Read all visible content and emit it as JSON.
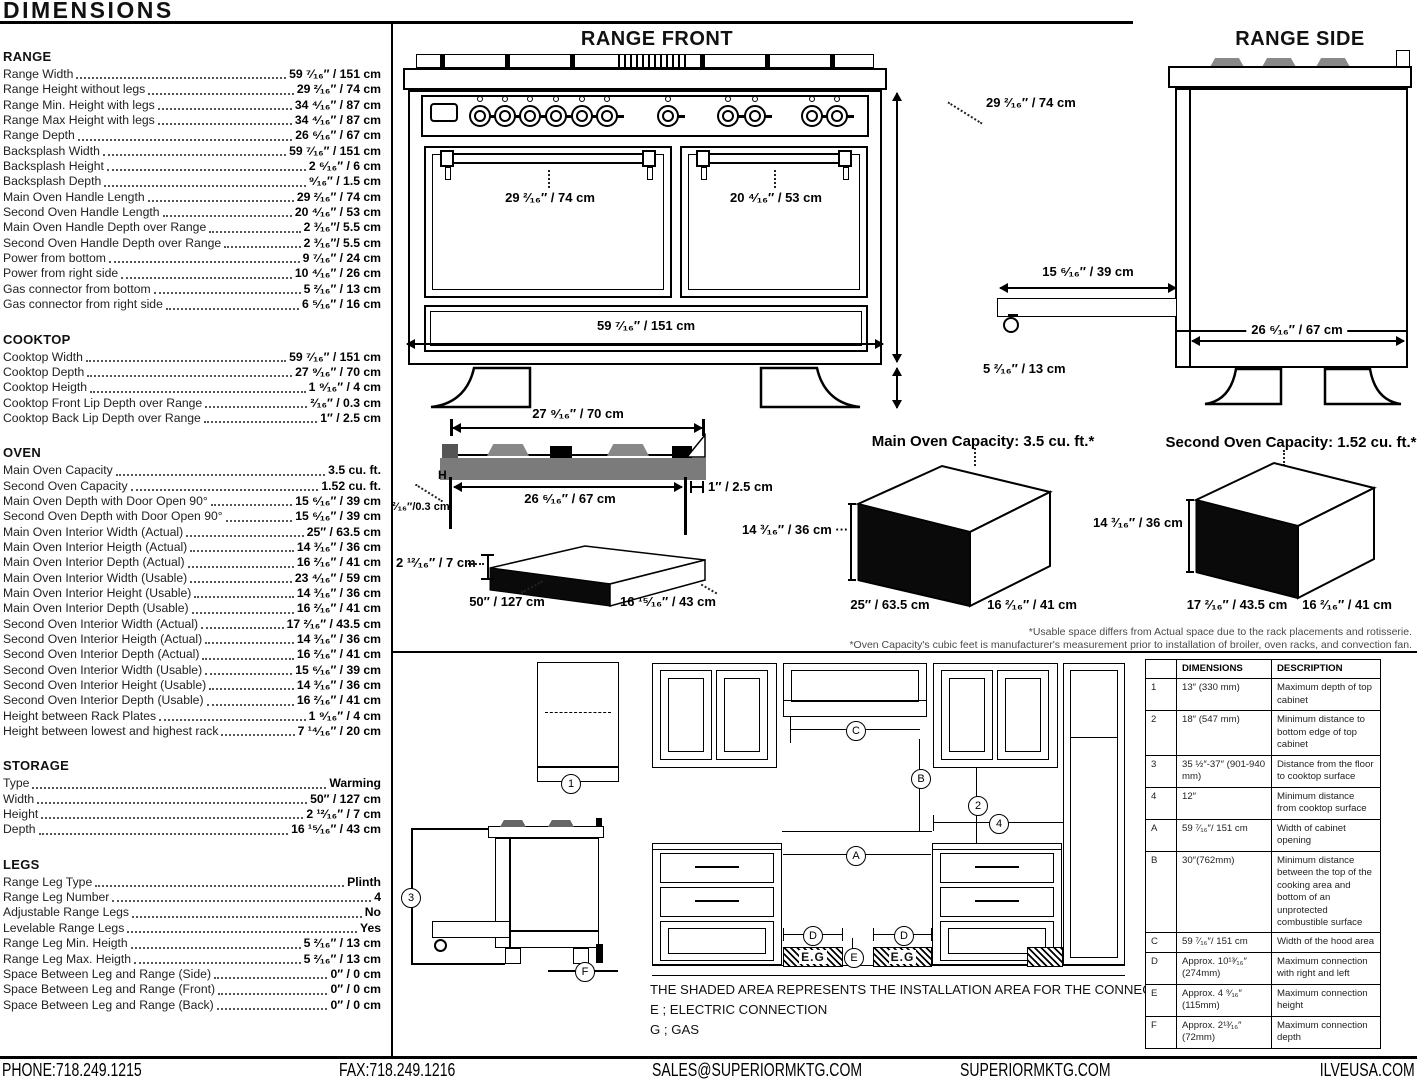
{
  "page": {
    "title": "DIMENSIONS"
  },
  "specs": {
    "sections": [
      {
        "heading": "RANGE",
        "rows": [
          {
            "label": "Range Width",
            "value": "59 ⁷⁄₁₆″ / 151 cm"
          },
          {
            "label": "Range Height without legs",
            "value": "29 ²⁄₁₆″ / 74 cm"
          },
          {
            "label": "Range Min. Height with legs",
            "value": "34 ⁴⁄₁₆″ / 87 cm"
          },
          {
            "label": "Range Max Height with legs",
            "value": "34 ⁴⁄₁₆″ / 87 cm"
          },
          {
            "label": "Range Depth",
            "value": "26 ⁶⁄₁₆″ / 67 cm"
          },
          {
            "label": "Backsplash Width",
            "value": "59 ⁷⁄₁₆″ / 151 cm"
          },
          {
            "label": "Backsplash Height",
            "value": "2 ⁶⁄₁₆″ / 6 cm"
          },
          {
            "label": "Backsplash Depth",
            "value": "⁹⁄₁₆″ / 1.5 cm"
          },
          {
            "label": "Main Oven Handle Length",
            "value": "29 ²⁄₁₆″ / 74 cm"
          },
          {
            "label": "Second Oven Handle Length",
            "value": "20 ⁴⁄₁₆″ / 53 cm"
          },
          {
            "label": "Main Oven Handle Depth over Range",
            "value": "2 ³⁄₁₆″/ 5.5 cm"
          },
          {
            "label": "Second Oven Handle Depth over Range",
            "value": "2 ³⁄₁₆″/ 5.5 cm"
          },
          {
            "label": "Power from bottom",
            "value": "9 ⁷⁄₁₆″ / 24 cm"
          },
          {
            "label": "Power from right side",
            "value": "10 ⁴⁄₁₆″ / 26 cm"
          },
          {
            "label": "Gas connector from bottom",
            "value": "5 ²⁄₁₆″ / 13 cm"
          },
          {
            "label": "Gas connector from right side",
            "value": "6 ⁵⁄₁₆″ / 16 cm"
          }
        ]
      },
      {
        "heading": "COOKTOP",
        "rows": [
          {
            "label": "Cooktop Width",
            "value": "59 ⁷⁄₁₆″ / 151 cm"
          },
          {
            "label": "Cooktop Depth",
            "value": "27 ⁹⁄₁₆″ / 70 cm"
          },
          {
            "label": "Cooktop Heigth",
            "value": "1 ⁹⁄₁₆″ / 4 cm"
          },
          {
            "label": "Cooktop Front Lip Depth over Range",
            "value": "²⁄₁₆″ / 0.3 cm"
          },
          {
            "label": "Cooktop Back Lip Depth over Range",
            "value": "1″ / 2.5 cm"
          }
        ]
      },
      {
        "heading": "OVEN",
        "rows": [
          {
            "label": "Main Oven Capacity",
            "value": "3.5 cu. ft."
          },
          {
            "label": "Second Oven Capacity",
            "value": "1.52 cu. ft."
          },
          {
            "label": "Main Oven Depth with Door Open 90°",
            "value": "15 ⁶⁄₁₆″ / 39 cm"
          },
          {
            "label": "Second Oven Depth with Door Open 90°",
            "value": "15 ⁶⁄₁₆″ / 39 cm"
          },
          {
            "label": "Main Oven Interior Width (Actual)",
            "value": "25″ / 63.5 cm"
          },
          {
            "label": "Main Oven Interior Heigth (Actual)",
            "value": "14 ³⁄₁₆″ / 36 cm"
          },
          {
            "label": "Main Oven Interior Depth (Actual)",
            "value": "16 ²⁄₁₆″ / 41 cm"
          },
          {
            "label": "Main Oven Interior Width (Usable)",
            "value": "23 ⁴⁄₁₆″ / 59 cm"
          },
          {
            "label": "Main Oven Interior Height (Usable)",
            "value": "14 ³⁄₁₆″ / 36 cm"
          },
          {
            "label": "Main Oven Interior Depth (Usable)",
            "value": "16 ²⁄₁₆″ / 41 cm"
          },
          {
            "label": "Second Oven Interior Width (Actual)",
            "value": "17 ²⁄₁₆″ / 43.5 cm"
          },
          {
            "label": "Second Oven Interior Heigth (Actual)",
            "value": "14 ³⁄₁₆″ / 36 cm"
          },
          {
            "label": "Second Oven Interior Depth (Actual)",
            "value": "16 ²⁄₁₆″ / 41 cm"
          },
          {
            "label": "Second Oven Interior Width (Usable)",
            "value": "15 ⁶⁄₁₆″ / 39 cm"
          },
          {
            "label": "Second Oven Interior Height (Usable)",
            "value": "14 ³⁄₁₆″ / 36 cm"
          },
          {
            "label": "Second Oven Interior Depth (Usable)",
            "value": "16 ²⁄₁₆″ / 41 cm"
          },
          {
            "label": "Height between Rack Plates",
            "value": "1 ⁹⁄₁₆″ / 4 cm"
          },
          {
            "label": "Height between lowest and highest rack",
            "value": "7 ¹⁴⁄₁₆″ / 20 cm"
          }
        ]
      },
      {
        "heading": "STORAGE",
        "rows": [
          {
            "label": "Type",
            "value": "Warming"
          },
          {
            "label": "Width",
            "value": "50″ / 127 cm"
          },
          {
            "label": "Height",
            "value": "2 ¹²⁄₁₆″ / 7 cm"
          },
          {
            "label": "Depth",
            "value": "16 ¹⁵⁄₁₆″ / 43 cm"
          }
        ]
      },
      {
        "heading": "LEGS",
        "rows": [
          {
            "label": "Range Leg Type",
            "value": "Plinth"
          },
          {
            "label": "Range Leg Number",
            "value": "4"
          },
          {
            "label": "Adjustable Range Legs",
            "value": "No"
          },
          {
            "label": "Levelable Range Legs",
            "value": "Yes"
          },
          {
            "label": "Range Leg Min. Heigth",
            "value": "5 ²⁄₁₆″ / 13 cm"
          },
          {
            "label": "Range Leg Max. Heigth",
            "value": "5 ²⁄₁₆″ / 13 cm"
          },
          {
            "label": "Space Between Leg and Range (Side)",
            "value": "0″ / 0 cm"
          },
          {
            "label": "Space Between Leg and Range (Front)",
            "value": "0″ / 0 cm"
          },
          {
            "label": "Space Between Leg and Range (Back)",
            "value": "0″ / 0 cm"
          }
        ]
      }
    ]
  },
  "diagrams": {
    "range_front": {
      "title": "RANGE FRONT",
      "handle_main": "29 ²⁄₁₆″ / 74 cm",
      "handle_second": "20 ⁴⁄₁₆″ / 53 cm",
      "width": "59 ⁷⁄₁₆″ / 151 cm",
      "height": "29 ²⁄₁₆″ / 74 cm",
      "legs": "5 ²⁄₁₆″ / 13 cm"
    },
    "range_side": {
      "title": "RANGE SIDE",
      "door_open": "15 ⁶⁄₁₆″ / 39 cm",
      "depth": "26 ⁶⁄₁₆″ / 67 cm"
    },
    "cooktop_profile": {
      "width_top": "27 ⁹⁄₁₆″ / 70 cm",
      "width_bottom": "26 ⁶⁄₁₆″ / 67 cm",
      "back_lip": "1″ / 2.5 cm",
      "front_lip": "²⁄₁₆″/0.3 cm",
      "h_mark": "H"
    },
    "storage_drawer": {
      "height": "2 ¹²⁄₁₆″ / 7 cm",
      "width": "50″ / 127 cm",
      "depth": "16 ¹⁵⁄₁₆″ / 43 cm"
    },
    "main_oven": {
      "title": "Main Oven Capacity: 3.5 cu. ft.*",
      "height": "14 ³⁄₁₆″ / 36 cm ···",
      "width": "25″ / 63.5 cm",
      "depth": "16 ²⁄₁₆″ / 41 cm"
    },
    "second_oven": {
      "title": "Second Oven Capacity: 1.52 cu. ft.*",
      "height": "14 ³⁄₁₆″ / 36 cm",
      "width": "17 ²⁄₁₆″ / 43.5 cm",
      "depth": "16 ²⁄₁₆″ / 41 cm"
    },
    "footnotes": [
      "*Usable space differs from Actual space due to the rack placements and rotisserie.",
      "*Oven Capacity's cubic feet is manufacturer's measurement prior to installation of broiler, oven racks, and convection fan."
    ]
  },
  "installation": {
    "side_callouts": [
      "1",
      "3",
      "F"
    ],
    "front_callouts": [
      "C",
      "B",
      "2",
      "4",
      "A",
      "D",
      "D",
      "E"
    ],
    "shaded_label": "E.G",
    "notes": [
      "THE SHADED AREA REPRESENTS THE INSTALLATION AREA FOR THE CONNECTIONS;",
      "E ; ELECTRIC CONNECTION",
      "G ; GAS"
    ],
    "table": {
      "headers": [
        "",
        "DIMENSIONS",
        "DESCRIPTION"
      ],
      "rows": [
        {
          "key": "1",
          "dim": "13″ (330 mm)",
          "desc": "Maximum depth of top cabinet"
        },
        {
          "key": "2",
          "dim": "18″ (547 mm)",
          "desc": "Minimum distance to bottom edge of top cabinet"
        },
        {
          "key": "3",
          "dim": "35 ½″-37″ (901-940 mm)",
          "desc": "Distance from the floor to cooktop surface"
        },
        {
          "key": "4",
          "dim": "12″",
          "desc": "Minimum distance from cooktop surface"
        },
        {
          "key": "A",
          "dim": "59 ⁷⁄₁₆″/ 151 cm",
          "desc": "Width of cabinet opening"
        },
        {
          "key": "B",
          "dim": "30″(762mm)",
          "desc": "Minimum distance between the top of the cooking area and bottom of an unprotected combustible surface"
        },
        {
          "key": "C",
          "dim": "59 ⁷⁄₁₆″/ 151 cm",
          "desc": "Width of the hood area"
        },
        {
          "key": "D",
          "dim": "Approx. 10¹³⁄₁₆″ (274mm)",
          "desc": "Maximum connection with right and left"
        },
        {
          "key": "E",
          "dim": "Approx. 4 ⁹⁄₁₆″ (115mm)",
          "desc": "Maximum connection height"
        },
        {
          "key": "F",
          "dim": "Approx. 2¹³⁄₁₆″ (72mm)",
          "desc": "Maximum connection depth"
        }
      ]
    }
  },
  "footer": {
    "items": [
      "PHONE:718.249.1215",
      "FAX:718.249.1216",
      "SALES@SUPERIORMKTG.COM",
      "SUPERIORMKTG.COM",
      "ILVEUSA.COM"
    ]
  }
}
